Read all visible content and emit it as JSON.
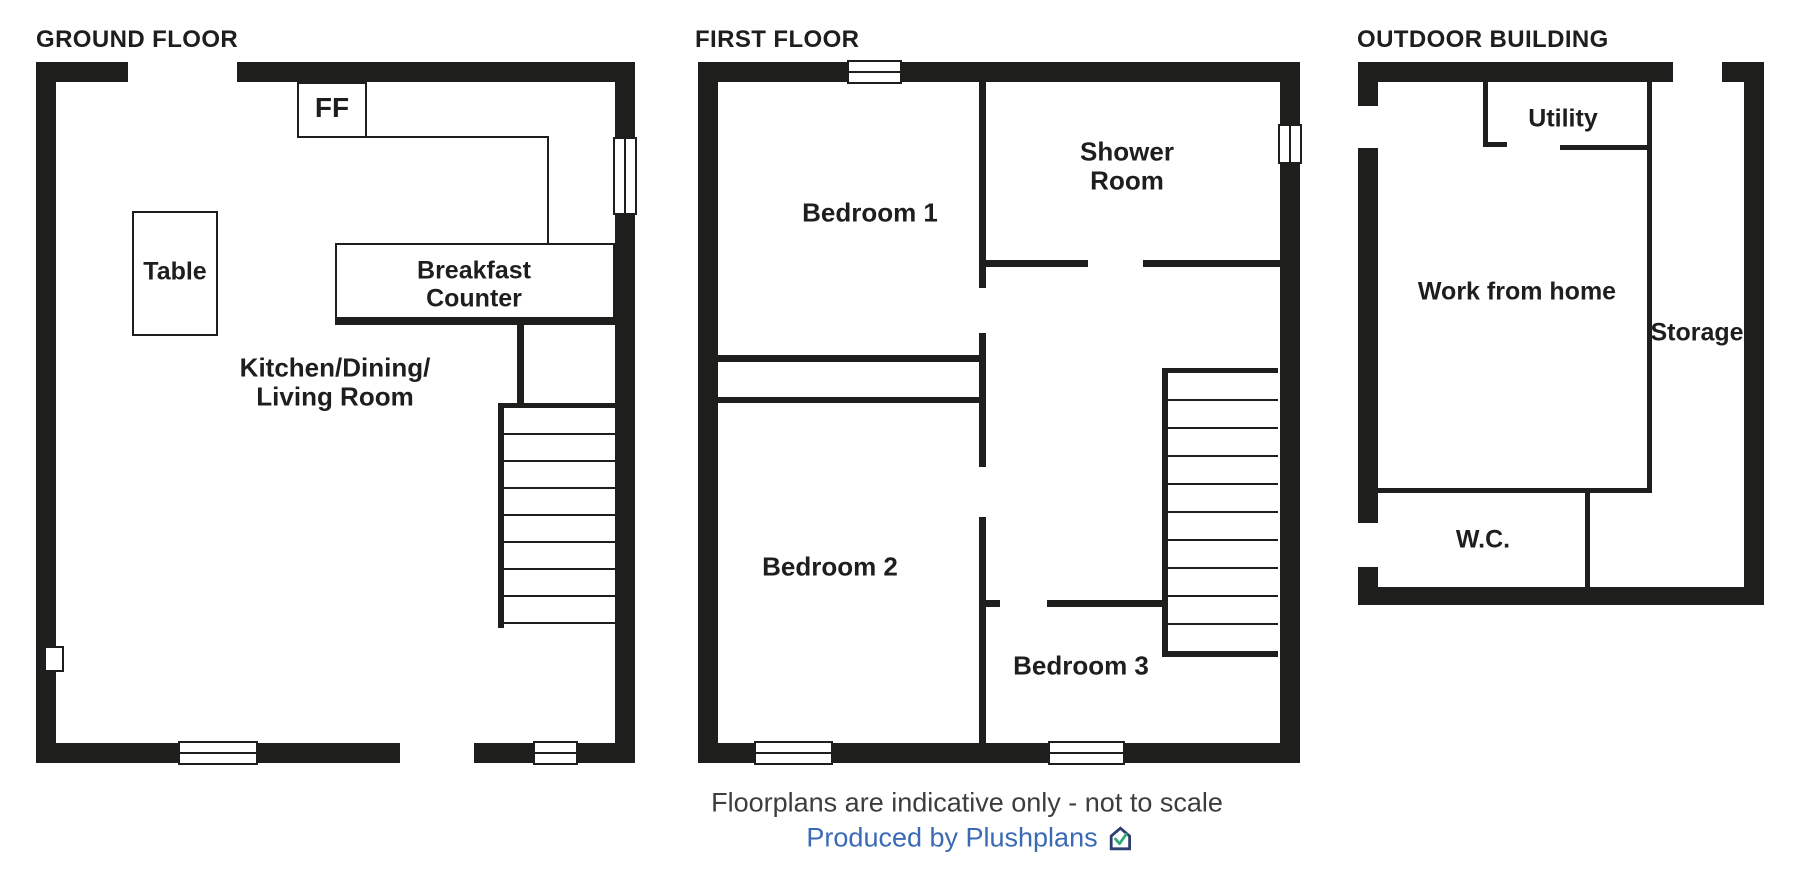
{
  "floors": {
    "ground": {
      "title": "GROUND FLOOR",
      "labels": {
        "ff": "FF",
        "table": "Table",
        "breakfast_counter": [
          "Breakfast",
          "Counter"
        ],
        "kitchen": [
          "Kitchen/Dining/",
          "Living Room"
        ]
      }
    },
    "first": {
      "title": "FIRST FLOOR",
      "labels": {
        "bedroom1": "Bedroom 1",
        "shower_room": [
          "Shower",
          "Room"
        ],
        "bedroom2": "Bedroom 2",
        "bedroom3": "Bedroom 3"
      }
    },
    "outdoor": {
      "title": "OUTDOOR BUILDING",
      "labels": {
        "utility": "Utility",
        "work_from_home": "Work from home",
        "storage": "Storage",
        "wc": "W.C."
      }
    }
  },
  "footer": {
    "disclaimer": "Floorplans are indicative only - not to scale",
    "credit": "Produced by Plushplans",
    "logo": "plushplans-house-check-logo"
  },
  "colors": {
    "wall": "#1e1e1c",
    "disclaimer_text": "#3d3d3d",
    "credit_text": "#3a6ab5",
    "logo_navy": "#2c3f6e",
    "logo_green": "#36a97c"
  }
}
